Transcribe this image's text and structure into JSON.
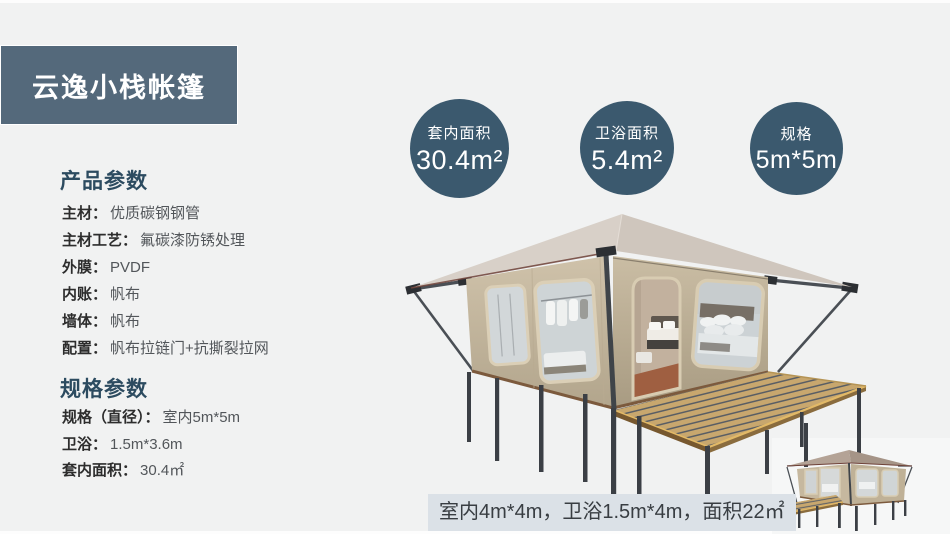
{
  "page": {
    "background": "#f1f2f2"
  },
  "header": {
    "title": "云逸小栈帐篷",
    "bg_color": "#54697b"
  },
  "badges": [
    {
      "label": "套内面积",
      "value": "30.4m²"
    },
    {
      "label": "卫浴面积",
      "value": "5.4m²"
    },
    {
      "label": "规格",
      "value": "5m*5m"
    }
  ],
  "badge_color": "#3b596e",
  "sections": [
    {
      "heading": "产品参数",
      "rows": [
        {
          "label": "主材：",
          "value": "优质碳钢钢管"
        },
        {
          "label": "主材工艺：",
          "value": "氟碳漆防锈处理"
        },
        {
          "label": "外膜：",
          "value": "PVDF"
        },
        {
          "label": "内账：",
          "value": "帆布"
        },
        {
          "label": "墙体：",
          "value": "帆布"
        },
        {
          "label": "配置：",
          "value": "帆布拉链门+抗撕裂拉网"
        }
      ]
    },
    {
      "heading": "规格参数",
      "rows": [
        {
          "label": "规格（直径）：",
          "value": "室内5m*5m"
        },
        {
          "label": "卫浴：",
          "value": "1.5m*3.6m"
        },
        {
          "label": "套内面积：",
          "value": "30.4㎡"
        }
      ]
    }
  ],
  "footer_note": "室内4m*4m，卫浴1.5m*4m，面积22㎡",
  "illustration": {
    "main": "safari-glamping-tent-3d-render-with-wood-deck",
    "thumbnail": "small-tent-variant-with-left-deck",
    "roof_color": "#d5cdc5",
    "wall_color": "#c8bba2",
    "deck_color": "#c8a76e",
    "frame_color": "#3c4046"
  }
}
